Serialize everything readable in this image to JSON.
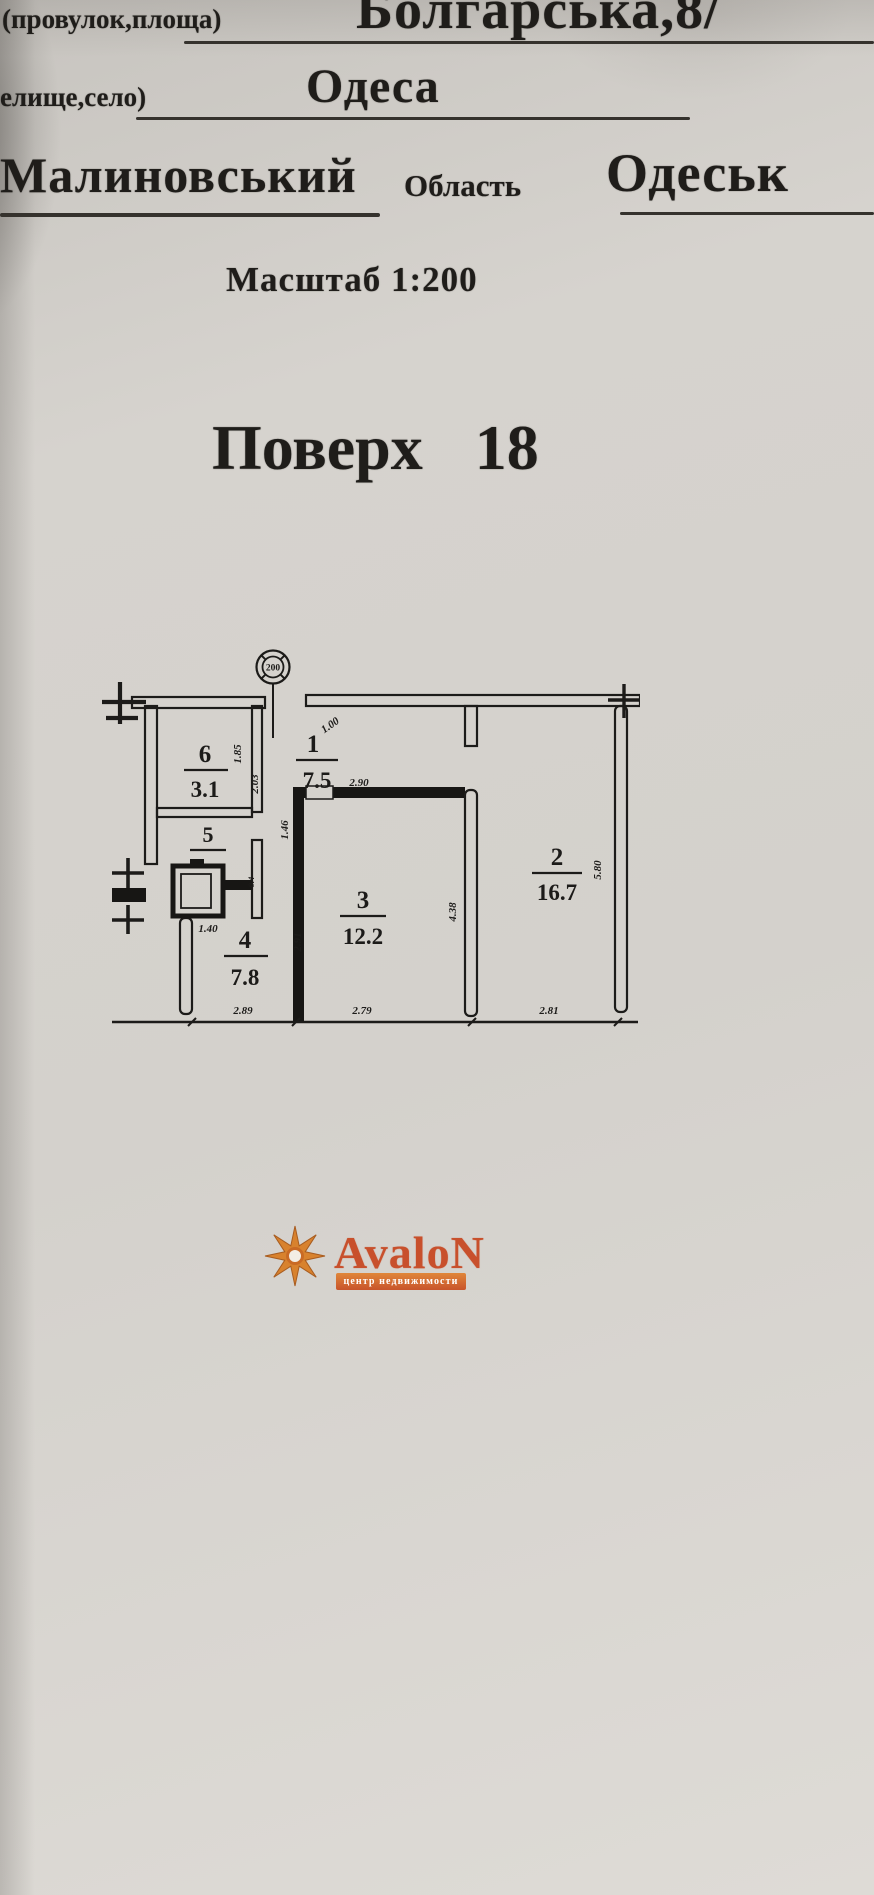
{
  "document": {
    "address_label": "(провулок,площа)",
    "address_value": "Болгарська,8/",
    "city_label": "елище,село)",
    "city_value": "Одеса",
    "district_value": "Малиновський",
    "region_label": "Область",
    "region_value": "Одеськ",
    "scale_line": "Масштаб 1:200",
    "floor_label": "Поверх",
    "floor_number": "18"
  },
  "plan": {
    "stamp_value": "200",
    "rooms": [
      {
        "number": "6",
        "area": "3.1"
      },
      {
        "number": "5",
        "area": ""
      },
      {
        "number": "1",
        "area": "7.5"
      },
      {
        "number": "4",
        "area": "7.8"
      },
      {
        "number": "3",
        "area": "12.2"
      },
      {
        "number": "2",
        "area": "16.7"
      }
    ],
    "dims": {
      "w185": "1.85",
      "w203": "2.03",
      "w100": "1.00",
      "w290": "2.90",
      "w146": "1.46",
      "w140": "1.40",
      "w04": "0.4",
      "w291": "2.91",
      "w438": "4.38",
      "w580": "5.80",
      "w289": "2.89",
      "w279": "2.79",
      "w281": "2.81"
    }
  },
  "watermark": {
    "brand": "AvaloN",
    "tagline": "центр недвижимости"
  },
  "colors": {
    "ink": "#1c1b19",
    "paper": "#d6d3ce",
    "brand_orange": "#c8542b",
    "brand_gold": "#d8822e"
  }
}
